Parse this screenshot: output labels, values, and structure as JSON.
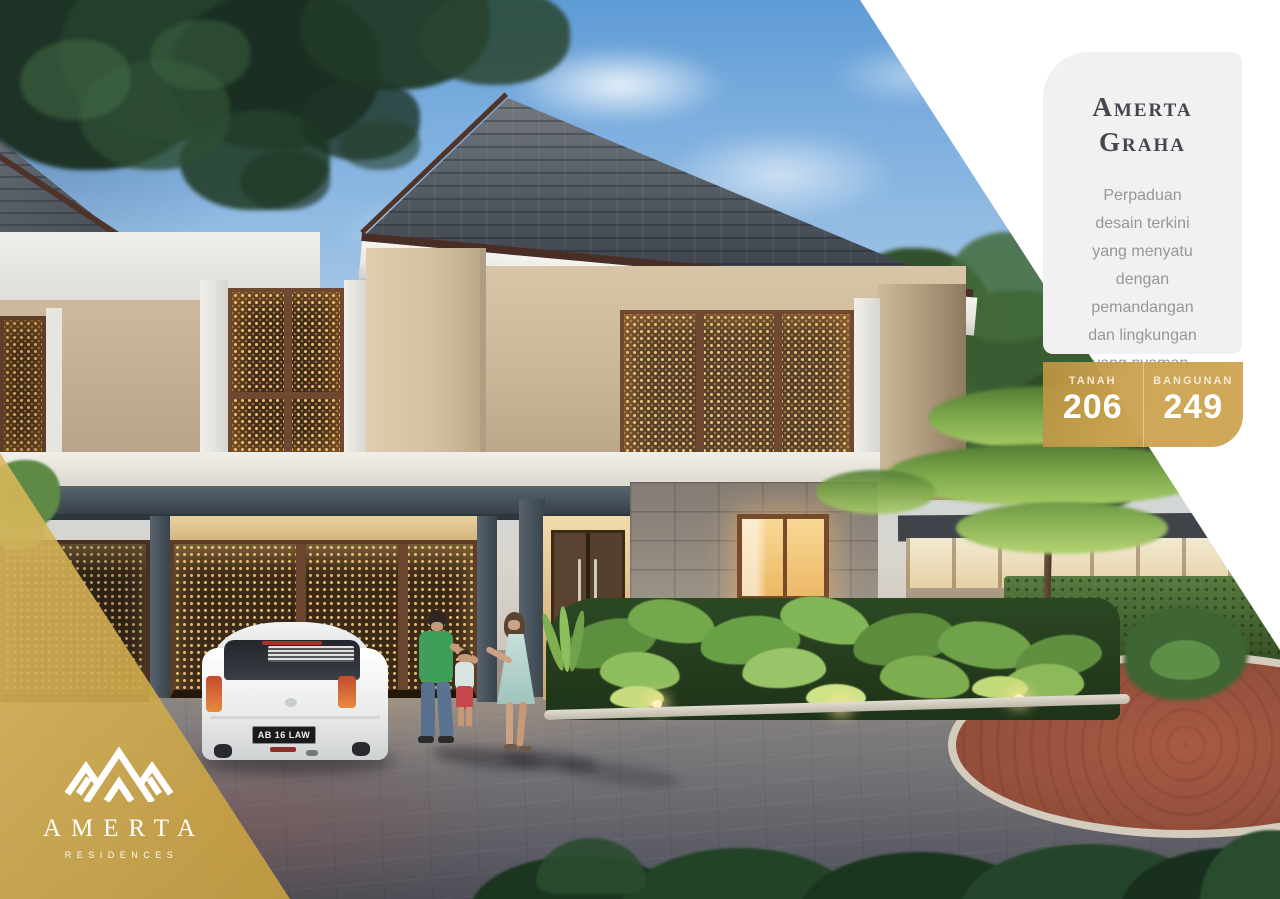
{
  "card": {
    "title": "Amerta\nGraha",
    "body": "Perpaduan\ndesain terkini\nyang menyatu\ndengan\npemandangan\ndan lingkungan\nyang nyaman."
  },
  "specs": {
    "tanah_label": "TANAH",
    "tanah_value": "206",
    "bangunan_label": "BANGUNAN",
    "bangunan_value": "249"
  },
  "logo": {
    "name": "AMERTA",
    "tagline": "RESIDENCES",
    "icon": "mountain-peaks-icon"
  },
  "car": {
    "plate": "AB 16 LAW"
  },
  "colors": {
    "gold": "#CBA253",
    "card_bg": "#F1F1F2",
    "title_text": "#45464F",
    "body_text": "#97979B",
    "badge_text": "#FFFFFF"
  }
}
